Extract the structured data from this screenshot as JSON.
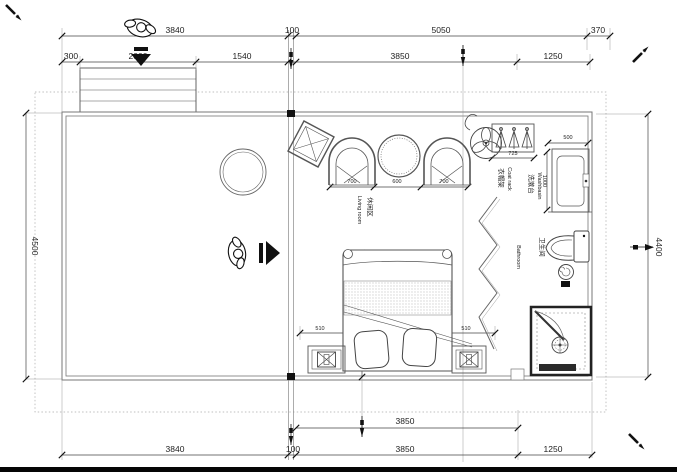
{
  "drawing": {
    "type": "floor-plan",
    "colors": {
      "line": "#555555",
      "wall": "#777777",
      "dim_text": "#222222",
      "black": "#111111",
      "dotted": "#aaaaaa",
      "paper": "#ffffff"
    },
    "icons": [
      "person-top-view-icon",
      "down-arrow-icon",
      "right-arrow-icon",
      "ceiling-fan-icon",
      "coat-hanger-icon",
      "toilet-icon",
      "washbasin-icon",
      "shower-drain-icon",
      "table-lamp-icon",
      "armchair-icon",
      "round-table-icon",
      "pen-marker-icon",
      "section-pin-icon"
    ]
  },
  "dims": {
    "top_3840": "3840",
    "top_100": "100",
    "top_5050": "5050",
    "top_370": "370",
    "top2_300": "300",
    "top2_2000": "2000",
    "top2_1540": "1540",
    "top2_3850": "3850",
    "top2_1250": "1250",
    "left_4500": "4500",
    "right_4400": "4400",
    "bottom_inner_3850": "3850",
    "bottom_3840": "3840",
    "bottom_100": "100",
    "bottom_3850": "3850",
    "bottom_1250": "1250",
    "living_700a": "700",
    "living_600": "600",
    "living_700b": "700",
    "coatrack_725": "725",
    "wash_500": "500",
    "wash_1000": "1000",
    "bed_510a": "510",
    "bed_1800": "1800",
    "bed_510b": "510",
    "bed_2000": "2000"
  },
  "labels": {
    "living_zh": "休闲区",
    "living_en": "Living room",
    "bedroom_zh": "睡眠区",
    "bedroom_en": "Bedroom",
    "bathroom_zh": "卫生间",
    "bathroom_en": "Bathroom",
    "washbasin_zh": "洗漱台",
    "washbasin_en": "Washbasin",
    "coatrack_zh": "衣帽架",
    "coatrack_en": "Coat rack",
    "shower_zh": "淋浴间",
    "shower_en": "Shower"
  }
}
